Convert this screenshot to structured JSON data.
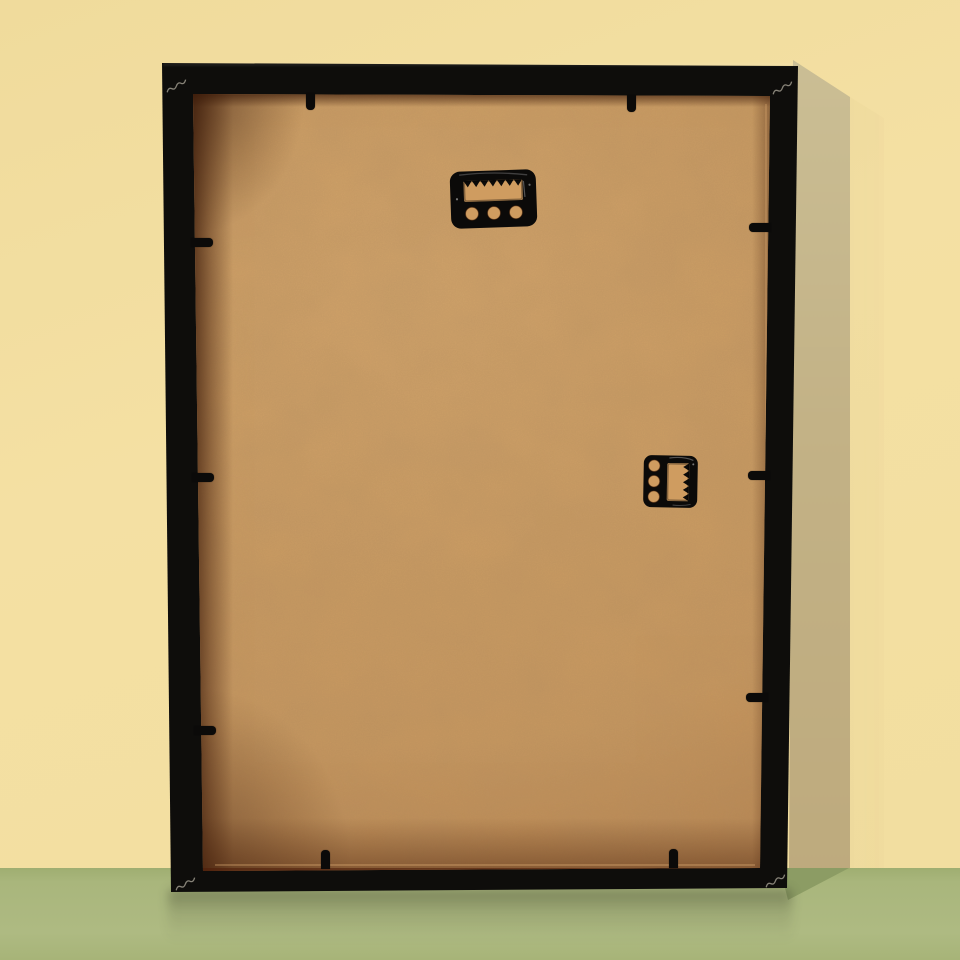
{
  "meta": {
    "title": "Rear view of a black box picture frame leaning against a pale yellow wall on a sage green floor",
    "alt": "Back of a black picture frame showing a kraft MDF backing board, two black sawtooth hangers, black flexible retaining tabs around the edges, and light corner-joint scratch marks"
  },
  "scene": {
    "colors": {
      "wall": "#f4e0a3",
      "wall_shadow_top": "#ccc097",
      "wall_shadow_bottom": "#bda97c",
      "floor": "#a9b67c",
      "floor_shadow": "#8c9c64",
      "frame_black": "#0e0d0b",
      "backing_light": "#dcab6e",
      "backing_mid": "#cf9c60",
      "backing_dark": "#b9834e",
      "hanger_black": "#0b0a09",
      "mark_light": "#d9d2c2"
    },
    "wall": {
      "label": "pale yellow wall"
    },
    "floor": {
      "label": "sage green floor",
      "horizon_y": 868
    },
    "frame": {
      "label": "black box picture frame, rear view",
      "backing_label": "kraft MDF backing board"
    },
    "hangers": [
      {
        "type": "sawtooth-hanger",
        "orientation": "horizontal-portrait",
        "x": 450,
        "y": 170,
        "w": 87,
        "h": 58,
        "rot": -2,
        "teeth": 7,
        "holes": 3
      },
      {
        "type": "sawtooth-hanger",
        "orientation": "vertical-landscape",
        "x": 643,
        "y": 455,
        "w": 55,
        "h": 53,
        "rot": 1,
        "teeth": 5,
        "holes": 3
      }
    ],
    "tabs": [
      {
        "edge": "top",
        "x": 306,
        "y": 93
      },
      {
        "edge": "top",
        "x": 627,
        "y": 95
      },
      {
        "edge": "bottom",
        "x": 321,
        "y": 850
      },
      {
        "edge": "bottom",
        "x": 669,
        "y": 849
      },
      {
        "edge": "left",
        "x": 191,
        "y": 238
      },
      {
        "edge": "left",
        "x": 192,
        "y": 473
      },
      {
        "edge": "left",
        "x": 194,
        "y": 726
      },
      {
        "edge": "right",
        "x": 749,
        "y": 223
      },
      {
        "edge": "right",
        "x": 748,
        "y": 471
      },
      {
        "edge": "right",
        "x": 746,
        "y": 693
      }
    ],
    "corner_marks": [
      {
        "corner": "top-left",
        "x": 163,
        "y": 70
      },
      {
        "corner": "top-right",
        "x": 769,
        "y": 72
      },
      {
        "corner": "bottom-left",
        "x": 172,
        "y": 868
      },
      {
        "corner": "bottom-right",
        "x": 762,
        "y": 865
      }
    ]
  }
}
